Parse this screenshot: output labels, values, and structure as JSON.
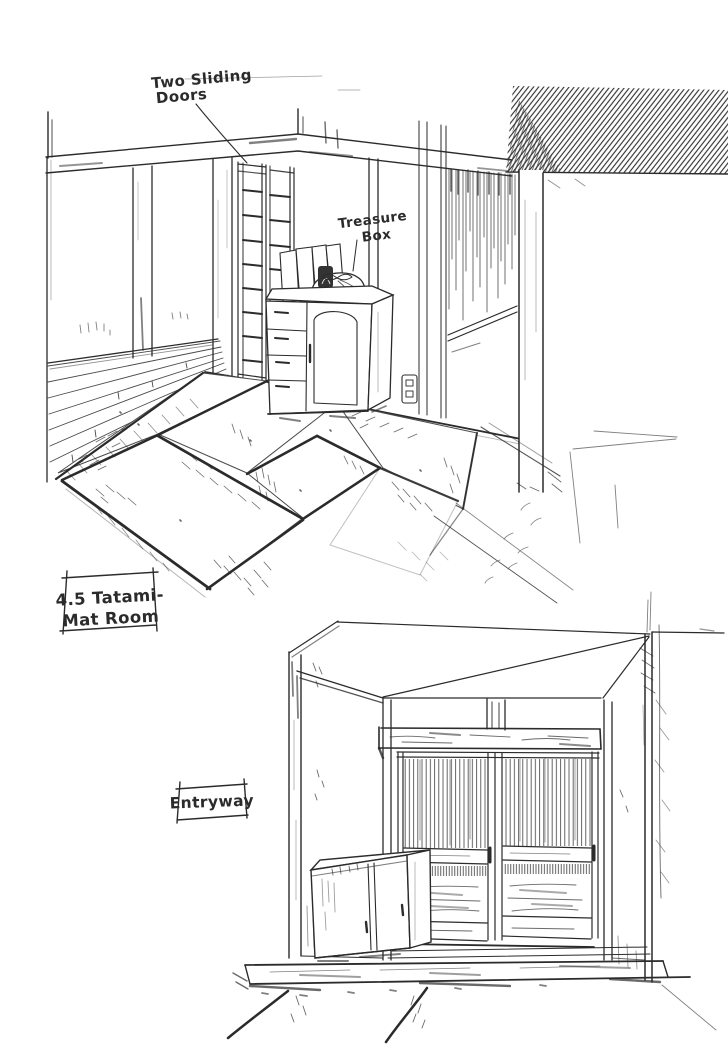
{
  "page": {
    "background_color": "#ffffff",
    "ink_color": "#2b2b2b"
  },
  "tatami_room_figure": {
    "label_box": {
      "line1": "4.5 Tatami-",
      "line2": "Mat Room"
    },
    "callout_sliding_doors": {
      "line1": "Two Sliding",
      "line2": "Doors"
    },
    "callout_treasure_box": {
      "line1": "Treasure",
      "line2": "Box"
    }
  },
  "entryway_figure": {
    "label_box": {
      "label": "Entryway"
    }
  }
}
